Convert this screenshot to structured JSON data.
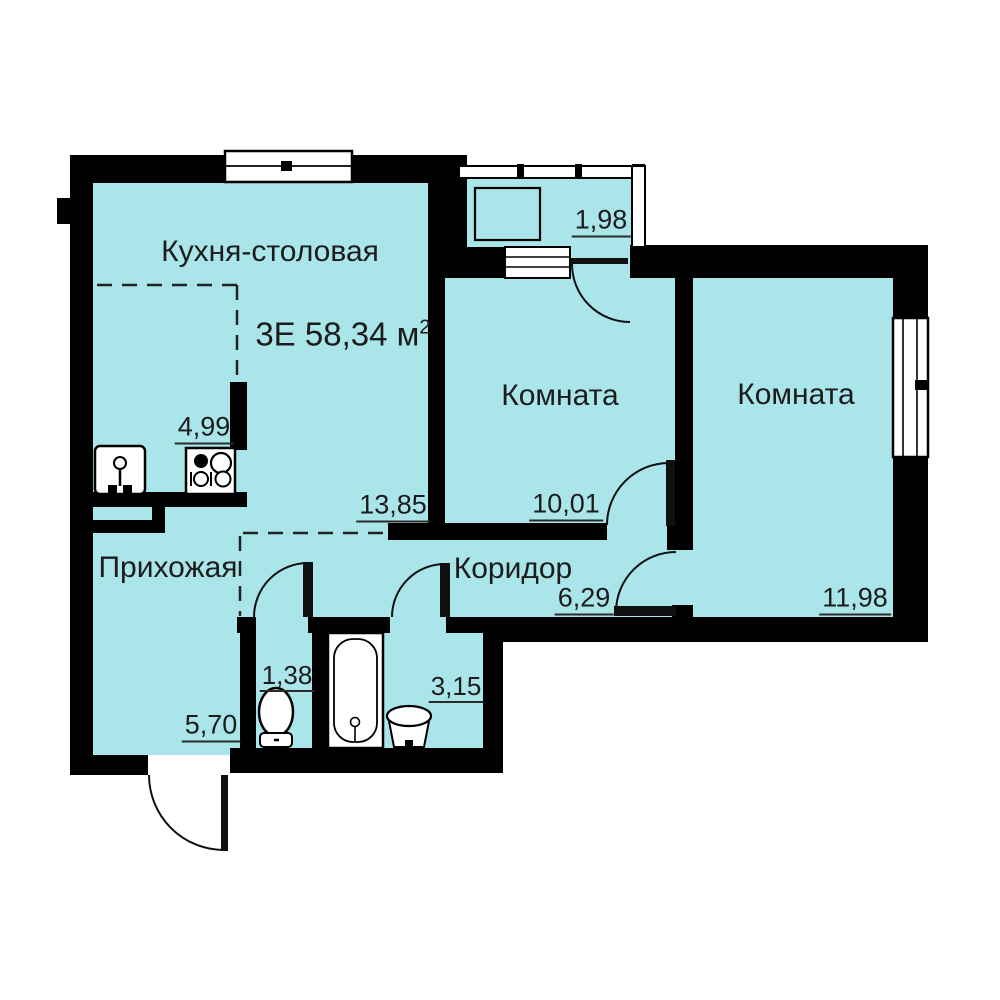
{
  "title": {
    "main": "3Е 58,34 м",
    "sup": "2"
  },
  "rooms": {
    "kitchen_dining": {
      "name": "Кухня-столовая",
      "area": "13,85",
      "kitchen_zone_area": "4,99"
    },
    "balcony": {
      "area": "1,98"
    },
    "room_top": {
      "name": "Комната",
      "area": "10,01"
    },
    "room_right": {
      "name": "Комната",
      "area": "11,98"
    },
    "hallway": {
      "name": "Прихожая",
      "area": "5,70"
    },
    "corridor": {
      "name": "Коридор",
      "area": "6,29"
    },
    "wc": {
      "area": "1,38"
    },
    "bathroom": {
      "area": "3,15"
    }
  },
  "colors": {
    "floor": "#a9e5e9",
    "wall": "#000000",
    "text": "#1c1c1c"
  }
}
